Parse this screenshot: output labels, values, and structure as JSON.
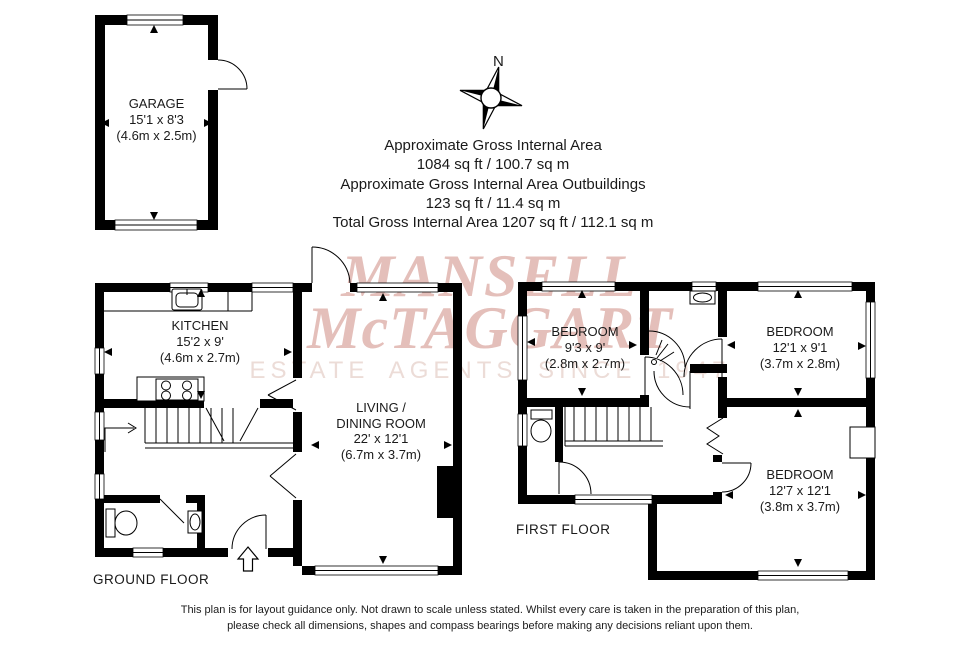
{
  "watermark": {
    "line1": "MANSELL",
    "line2": "McTAGGART",
    "line3": "ESTATE AGENTS SINCE 1947"
  },
  "compass": {
    "label": "N"
  },
  "area_summary": {
    "line1": "Approximate Gross Internal Area",
    "line2": "1084 sq ft / 100.7 sq m",
    "line3": "Approximate Gross Internal Area Outbuildings",
    "line4": "123 sq ft / 11.4 sq m",
    "line5": "Total Gross Internal Area 1207 sq ft / 112.1 sq m"
  },
  "rooms": {
    "garage": {
      "name": "GARAGE",
      "imperial": "15'1 x 8'3",
      "metric": "(4.6m x 2.5m)"
    },
    "kitchen": {
      "name": "KITCHEN",
      "imperial": "15'2 x 9'",
      "metric": "(4.6m x 2.7m)"
    },
    "living": {
      "name1": "LIVING /",
      "name2": "DINING ROOM",
      "imperial": "22' x 12'1",
      "metric": "(6.7m x 3.7m)"
    },
    "bedroom1": {
      "name": "BEDROOM",
      "imperial": "9'3 x 9'",
      "metric": "(2.8m x 2.7m)"
    },
    "bedroom2": {
      "name": "BEDROOM",
      "imperial": "12'1 x 9'1",
      "metric": "(3.7m x 2.8m)"
    },
    "bedroom3": {
      "name": "BEDROOM",
      "imperial": "12'7 x 12'1",
      "metric": "(3.8m x 3.7m)"
    }
  },
  "floor_labels": {
    "ground": "GROUND FLOOR",
    "first": "FIRST FLOOR"
  },
  "footer": {
    "line1": "This plan is for layout guidance only. Not drawn to scale unless stated. Whilst every care is taken in the preparation of this plan,",
    "line2": "please check all dimensions, shapes and compass bearings before making any decisions reliant upon them."
  },
  "colors": {
    "wall": "#000000",
    "watermark_pink": "#e4bfba",
    "watermark_light": "#ecdcd7"
  }
}
